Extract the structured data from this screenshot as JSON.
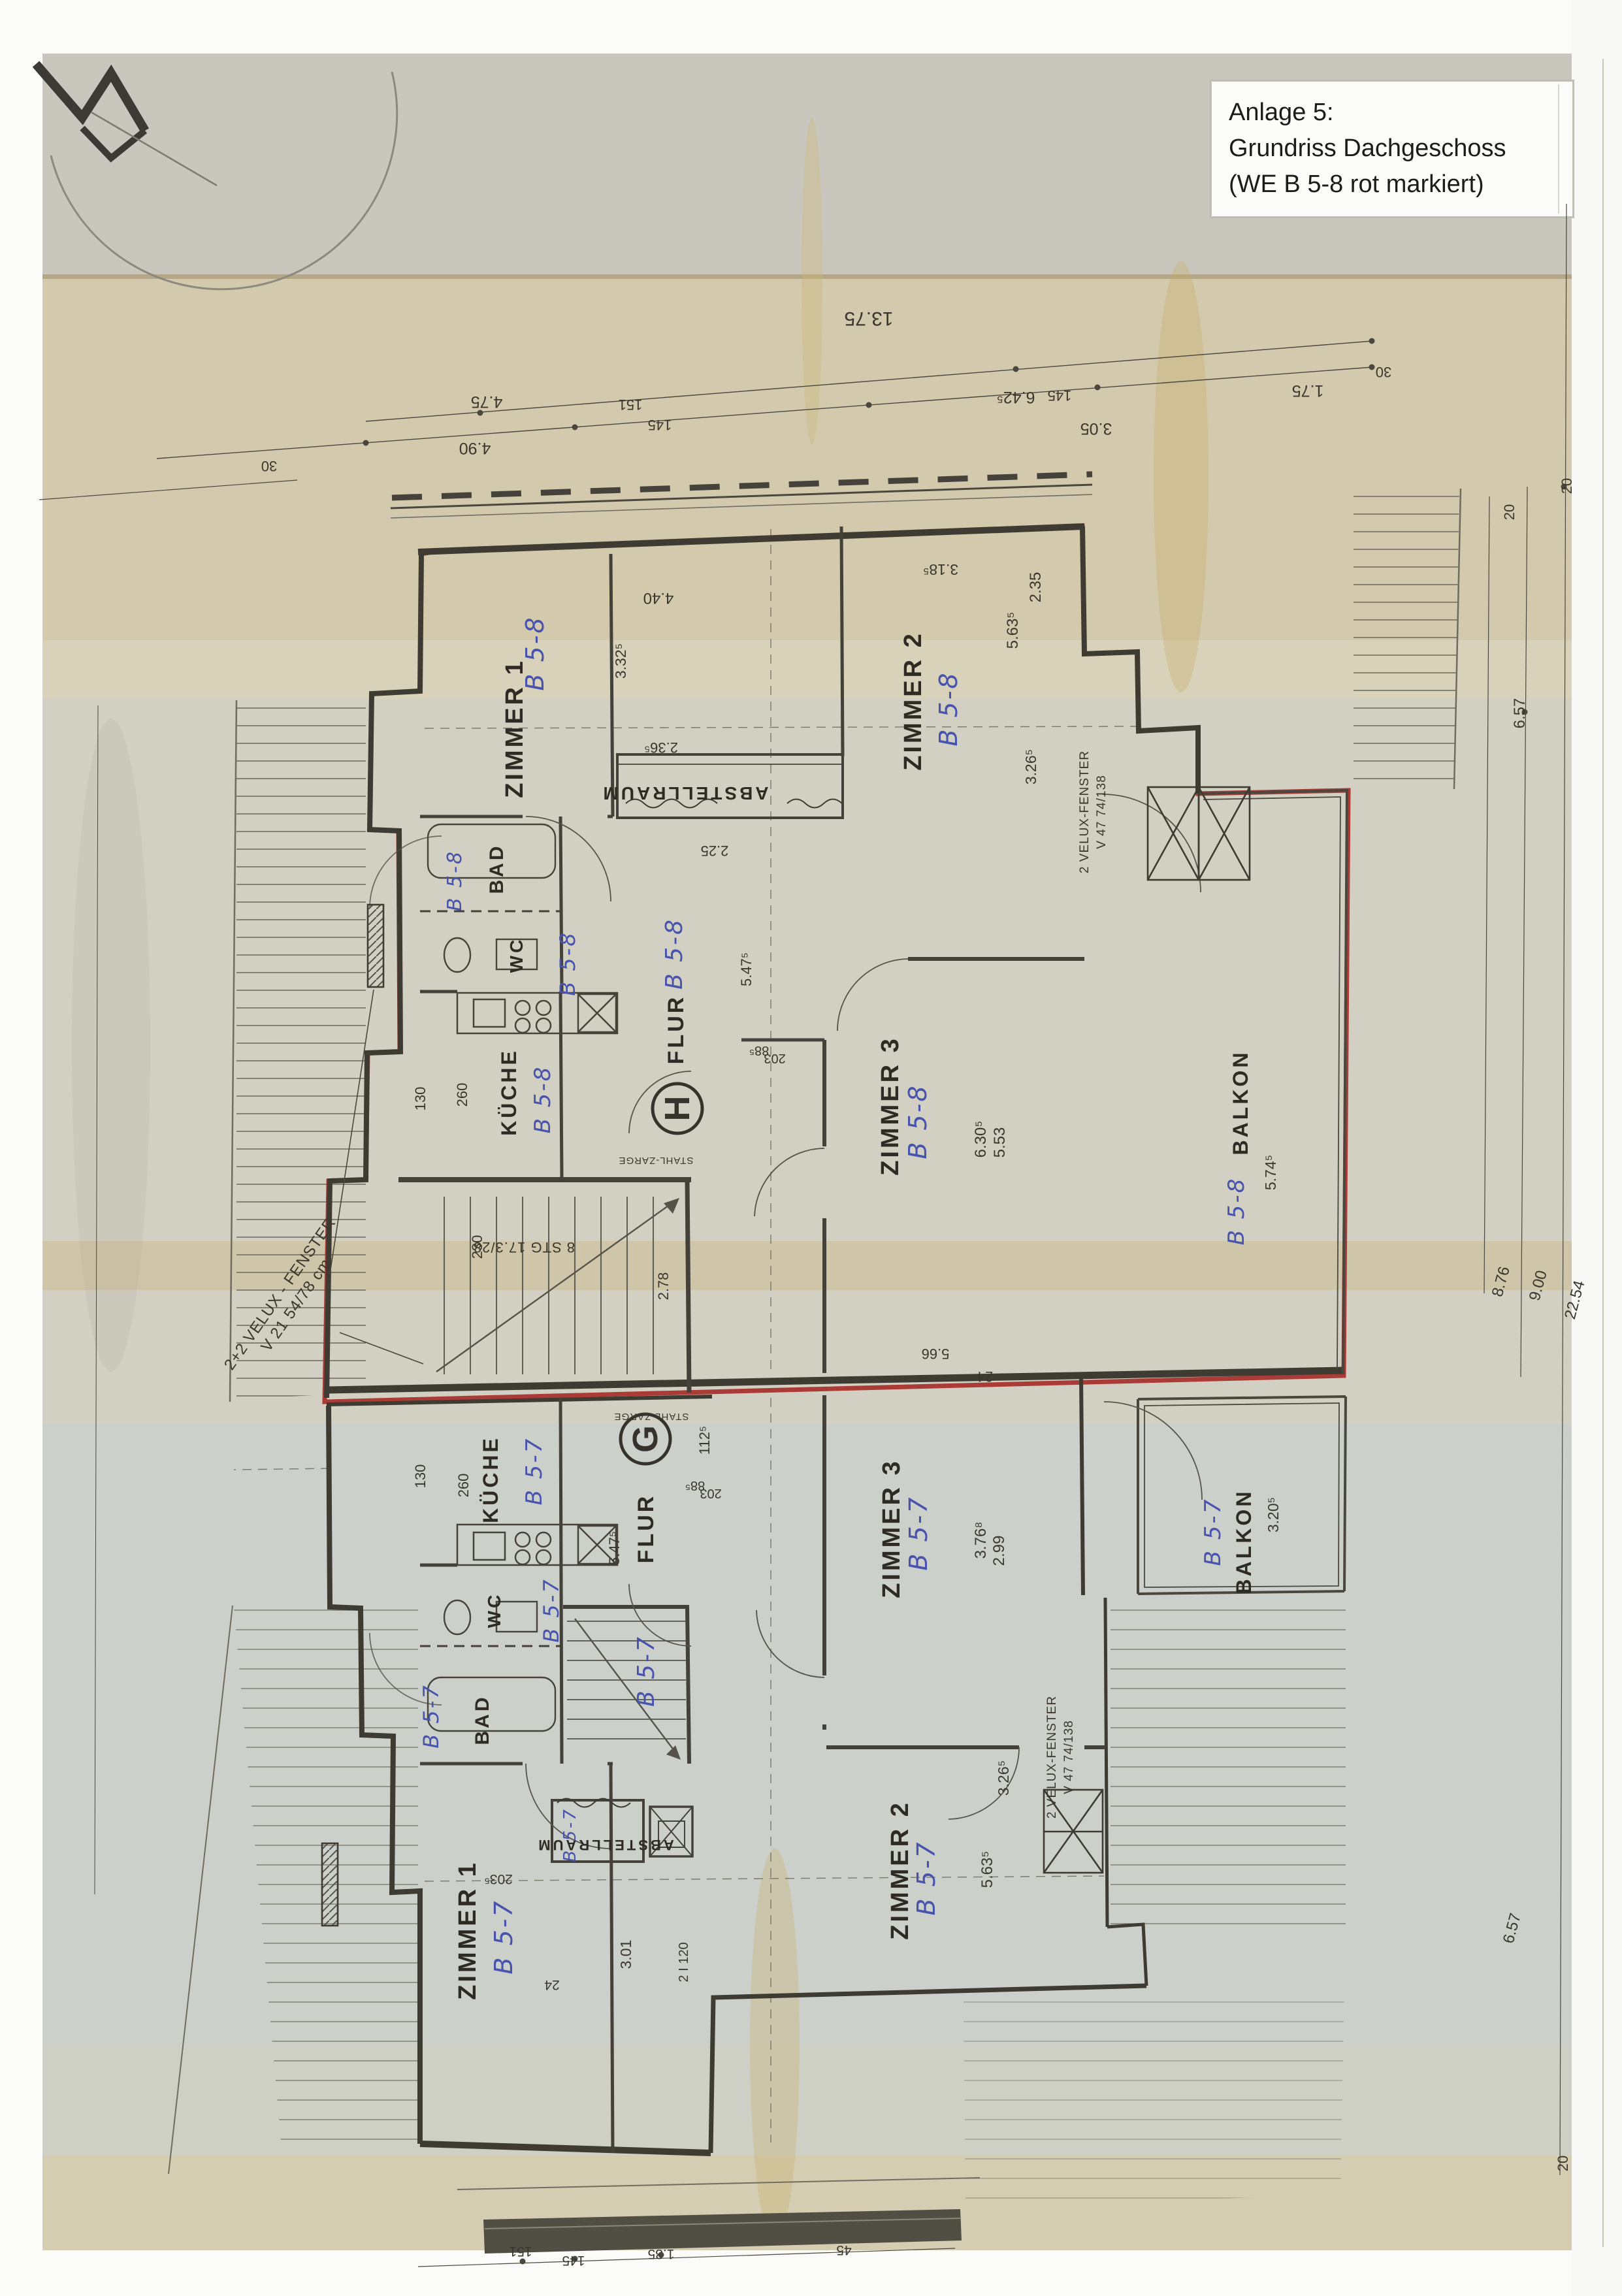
{
  "note_box": {
    "line1": "Anlage 5:",
    "line2": "Grundriss Dachgeschoss",
    "line3": "(WE B 5-8 rot markiert)"
  },
  "rooms": {
    "zimmer1": "ZIMMER 1",
    "zimmer2": "ZIMMER 2",
    "zimmer3": "ZIMMER 3",
    "flur": "FLUR",
    "kueche": "KÜCHE",
    "bad": "BAD",
    "wc": "WC",
    "balkon": "BALKON",
    "abstellraum": "ABSTELLRAUM"
  },
  "codes": {
    "upper": "B 5-8",
    "lower": "B 5-7"
  },
  "stairwells": {
    "upper": "H",
    "lower": "G"
  },
  "annotations": {
    "velux_line1": "2 VELUX-FENSTER",
    "velux_line2": "V 47  74/138",
    "velux_left1": "2+2 VELUX - FENSTER",
    "velux_left2": "V 21  54/78 cm",
    "stair_note": "8 STG 17.3/28",
    "steel_frame": "STAHL-ZARGE"
  },
  "dims": {
    "d13_75": "13.75",
    "d642": "6.42⁵",
    "d305": "3.05",
    "d175": "1.75",
    "d30": "30",
    "d490": "4.90",
    "d475": "4.75",
    "d145": "145",
    "d151": "151",
    "d318": "3.18⁵",
    "d440": "4.40",
    "d236": "2.36⁵",
    "d225": "2.25",
    "d332": "3.32⁵",
    "d235": "2.35",
    "d563": "5.63⁵",
    "d326": "3.26⁵",
    "d630": "6.30⁵",
    "d553": "5.53",
    "d547": "5.47⁵",
    "d885": "88⁵",
    "d203": "203",
    "d260": "260",
    "d130": "130",
    "d230": "230",
    "d278": "2.78",
    "d574": "5.74⁵",
    "d657": "6.57",
    "d876": "8.76",
    "d900": "9.00",
    "d2254": "22.54",
    "d20": "20",
    "d1125": "112⁵",
    "d376": "3.76⁸",
    "d299": "2.99",
    "d320": "3.20⁵",
    "d301": "3.01",
    "d2i120": "2 I 120",
    "d203s": "203⁵",
    "d24": "24",
    "d566": "5.66",
    "d135": "1.35",
    "d45": "45"
  }
}
